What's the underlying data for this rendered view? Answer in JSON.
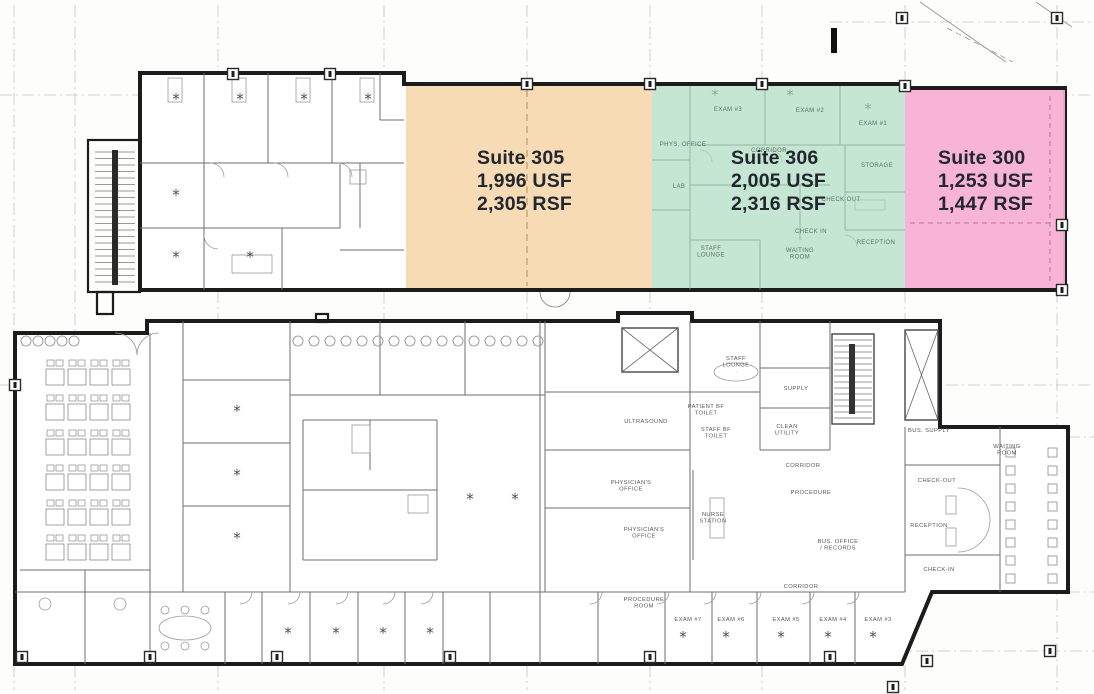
{
  "suites": [
    {
      "id": "suite-305",
      "name": "Suite 305",
      "usf": "1,996 USF",
      "rsf": "2,305 RSF",
      "color": "#f7d9b1"
    },
    {
      "id": "suite-306",
      "name": "Suite 306",
      "usf": "2,005 USF",
      "rsf": "2,316 RSF",
      "color": "#a8dabd"
    },
    {
      "id": "suite-300",
      "name": "Suite 300",
      "usf": "1,253 USF",
      "rsf": "1,447 RSF",
      "color": "#f8b0d5"
    }
  ],
  "upper_plan_labels": [
    {
      "text": "EXAM #3",
      "x": 728,
      "y": 111
    },
    {
      "text": "EXAM #2",
      "x": 810,
      "y": 112
    },
    {
      "text": "EXAM #1",
      "x": 873,
      "y": 125
    },
    {
      "text": "PHYS. OFFICE",
      "x": 683,
      "y": 146
    },
    {
      "text": "CORRIDOR",
      "x": 769,
      "y": 152
    },
    {
      "text": "LAB",
      "x": 679,
      "y": 188
    },
    {
      "text": "STORAGE",
      "x": 877,
      "y": 167
    },
    {
      "text": "CHECK OUT",
      "x": 841,
      "y": 201
    },
    {
      "text": "CHECK IN",
      "x": 811,
      "y": 233
    },
    {
      "text": "STAFF LOUNGE",
      "x": 711,
      "y": 250,
      "m": true
    },
    {
      "text": "WAITING ROOM",
      "x": 800,
      "y": 252,
      "m": true
    },
    {
      "text": "RECEPTION",
      "x": 876,
      "y": 244
    }
  ],
  "lower_plan_labels": [
    {
      "text": "STAFF LOUNGE",
      "x": 736,
      "y": 360,
      "m": true
    },
    {
      "text": "BUS. SUPPLY",
      "x": 929,
      "y": 432
    },
    {
      "text": "SUPPLY",
      "x": 796,
      "y": 390
    },
    {
      "text": "ULTRASOUND",
      "x": 646,
      "y": 423
    },
    {
      "text": "PATIENT BF TOILET",
      "x": 706,
      "y": 408,
      "m": true
    },
    {
      "text": "STAFF BF TOILET",
      "x": 716,
      "y": 431,
      "m": true
    },
    {
      "text": "CLEAN UTILITY",
      "x": 787,
      "y": 428,
      "m": true
    },
    {
      "text": "WAITING ROOM",
      "x": 1007,
      "y": 448,
      "m": true
    },
    {
      "text": "CHECK-OUT",
      "x": 937,
      "y": 482
    },
    {
      "text": "CORRIDOR",
      "x": 803,
      "y": 467
    },
    {
      "text": "PROCEDURE",
      "x": 811,
      "y": 494
    },
    {
      "text": "PHYSICIAN'S OFFICE",
      "x": 631,
      "y": 484,
      "m": true
    },
    {
      "text": "PHYSICIAN'S OFFICE",
      "x": 644,
      "y": 531,
      "m": true
    },
    {
      "text": "NURSE STATION",
      "x": 713,
      "y": 516,
      "m": true
    },
    {
      "text": "RECEPTION",
      "x": 929,
      "y": 527
    },
    {
      "text": "BUS. OFFICE / RECORDS",
      "x": 838,
      "y": 543,
      "m": true
    },
    {
      "text": "CHECK-IN",
      "x": 939,
      "y": 571
    },
    {
      "text": "CORRIDOR",
      "x": 801,
      "y": 588
    },
    {
      "text": "PROCEDURE ROOM",
      "x": 644,
      "y": 601,
      "m": true
    },
    {
      "text": "EXAM #7",
      "x": 688,
      "y": 621
    },
    {
      "text": "EXAM #6",
      "x": 731,
      "y": 621
    },
    {
      "text": "EXAM #5",
      "x": 786,
      "y": 621
    },
    {
      "text": "EXAM #4",
      "x": 833,
      "y": 621
    },
    {
      "text": "EXAM #3",
      "x": 878,
      "y": 621
    }
  ]
}
